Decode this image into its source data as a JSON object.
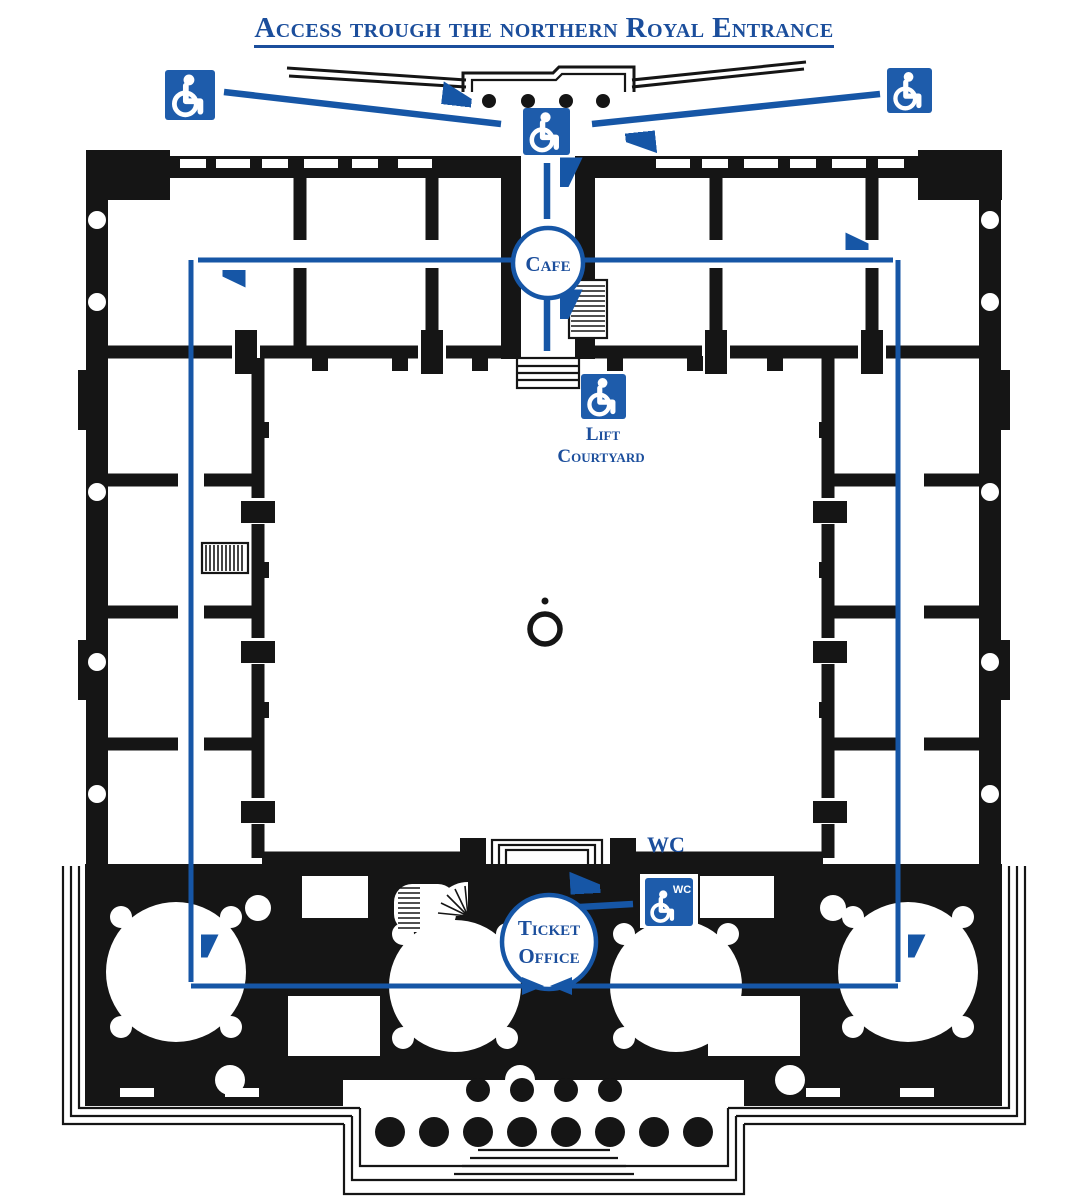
{
  "colors": {
    "line_blue": "#1656a6",
    "icon_blue": "#1e5cab",
    "text_blue": "#1b4e9c",
    "plan_ink": "#151515",
    "background": "#ffffff"
  },
  "title": "Access trough the northern Royal Entrance",
  "labels": {
    "cafe": "Cafe",
    "lift_line1": "Lift",
    "lift_line2": "Courtyard",
    "wc": "WC",
    "wc_badge": "WC",
    "ticket_line1": "Ticket",
    "ticket_line2": "Office"
  },
  "icons": [
    {
      "name": "wheelchair-icon",
      "location": "outside-north-west"
    },
    {
      "name": "wheelchair-icon",
      "location": "outside-north-east"
    },
    {
      "name": "wheelchair-icon",
      "location": "northern-royal-entrance"
    },
    {
      "name": "wheelchair-icon",
      "location": "courtyard-lift"
    },
    {
      "name": "wheelchair-wc-icon",
      "location": "ticket-office-wc"
    }
  ]
}
